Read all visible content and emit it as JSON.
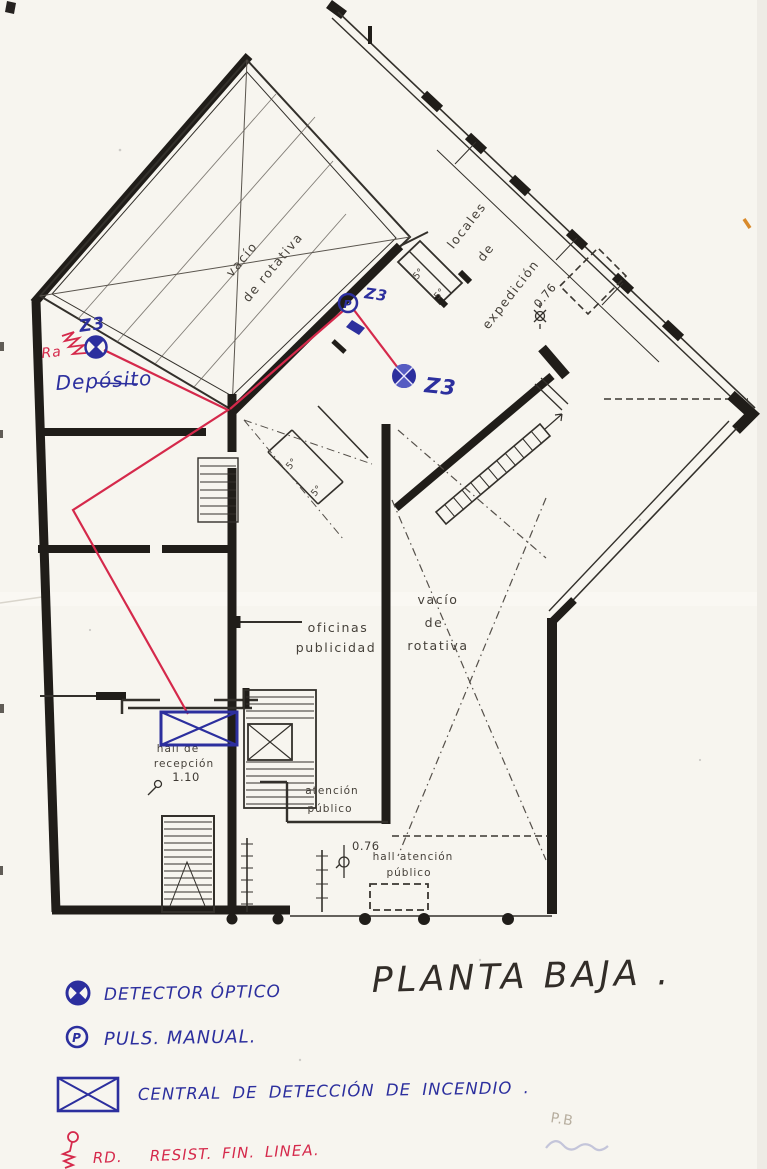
{
  "colors": {
    "paper": "#f7f5ef",
    "plan_black": "#201d19",
    "ink_blue": "#2c2f9e",
    "ink_red": "#d5294b"
  },
  "title": "PLANTA BAJA .",
  "plan": {
    "rotativa_top": [
      "vacío",
      "de rotativa"
    ],
    "locales": [
      "locales",
      "de",
      "expedición"
    ],
    "dim_expedicion": "0.76",
    "room5": "5°",
    "oficinas": [
      "oficinas",
      "publicidad"
    ],
    "rotativa_center": [
      "vacío",
      "de",
      "rotativa"
    ],
    "hall_recepcion": [
      "hall de",
      "recepción",
      "1.10"
    ],
    "atencion": [
      "atención",
      "público"
    ],
    "hall_atencion_dim": "0.76",
    "hall_atencion": [
      "hall atención",
      "público"
    ]
  },
  "annotations": {
    "zone": "Z3",
    "deposito": "Depósito",
    "ra": "Ra",
    "pulsador_letter": "P",
    "pencil_note": "P.B"
  },
  "legend": {
    "detector": "DETECTOR ÓPTICO",
    "pulsador": "PULS. MANUAL.",
    "pulsador_letter": "P",
    "central": "CENTRAL DE DETECCIÓN DE INCENDIO .",
    "eol_prefix": "RD.",
    "eol": "RESIST. FIN. LINEA."
  }
}
